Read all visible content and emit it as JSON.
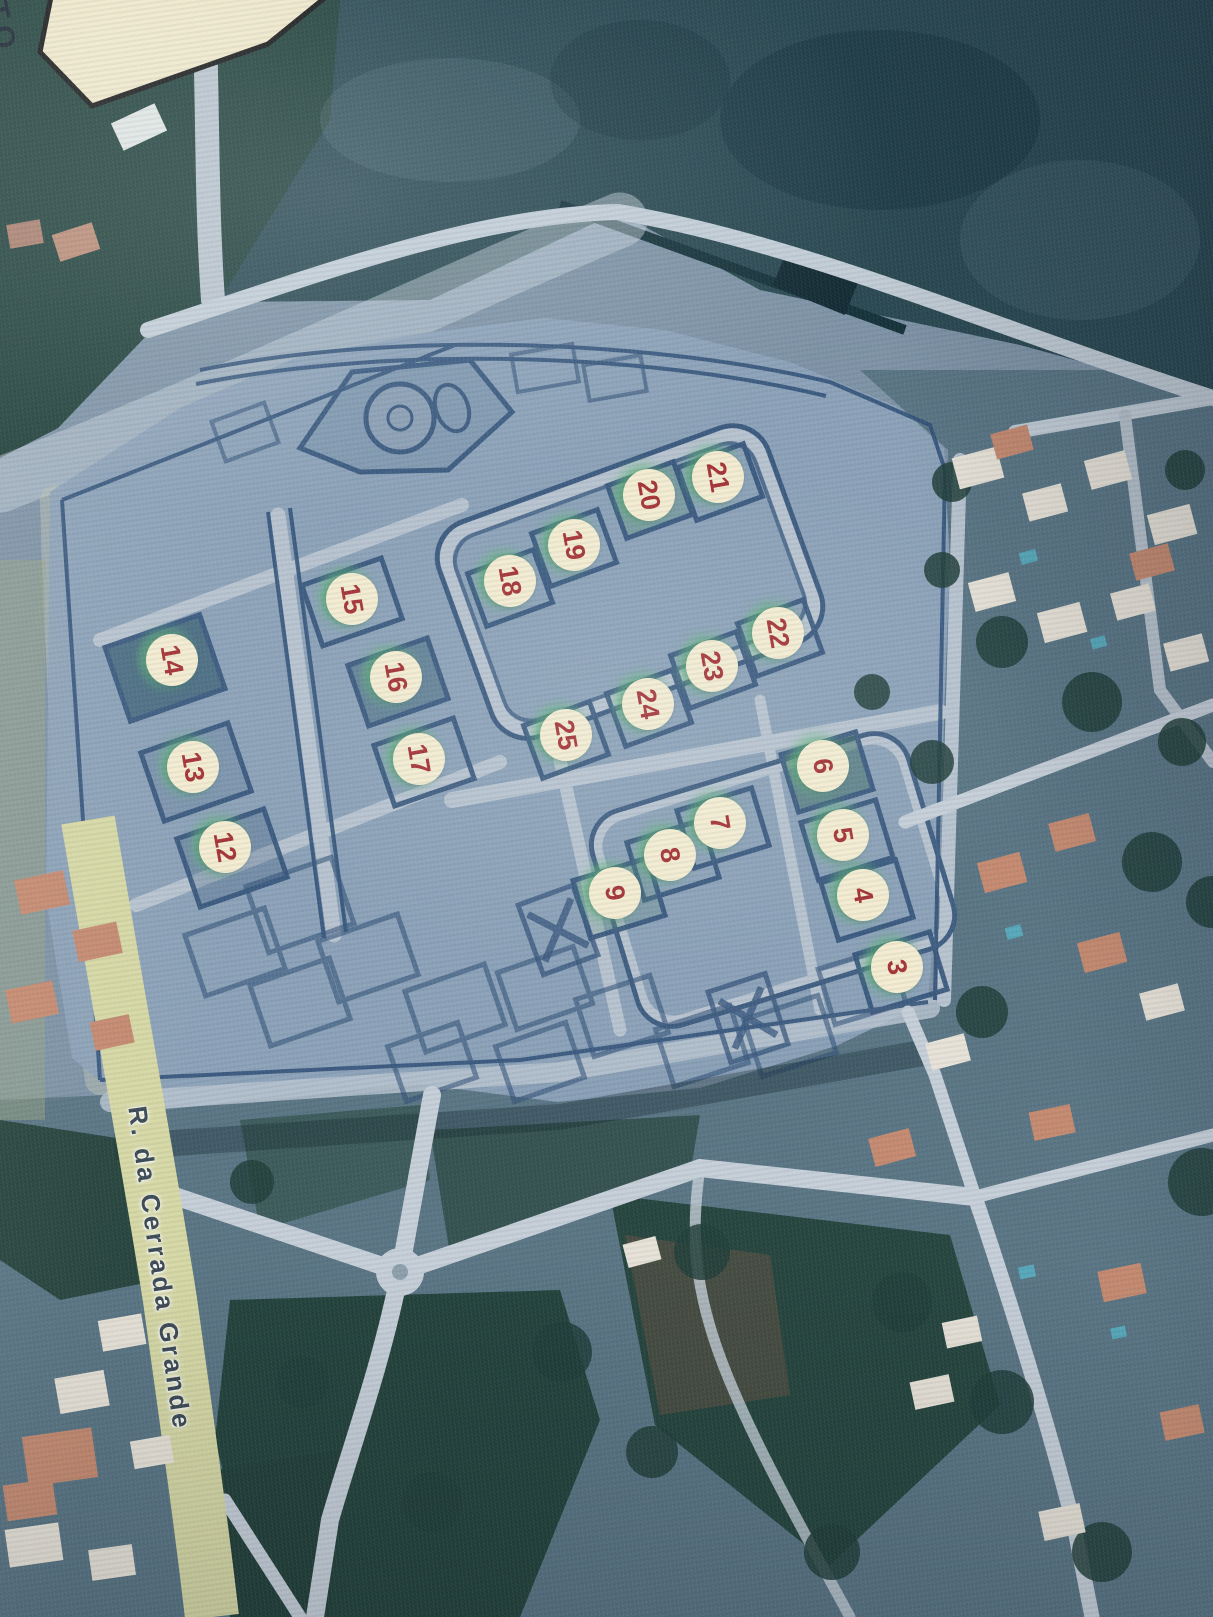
{
  "scene": {
    "description": "Aerial satellite photo of a planned housing development with numbered lot stickers",
    "street_label": "R. da Cerrada Grande",
    "corner_note": "TO"
  },
  "colors": {
    "marker_fill": "#f3ecd1",
    "marker_number": "#a53336",
    "marker_glow": "#6fbf85",
    "street_label_text": "#3c4a55",
    "road_yellow": "#d6d8a5",
    "plat_fill": "#8da2b8",
    "lot_line": "#315178"
  },
  "markers": [
    {
      "number": "3",
      "x": 897,
      "y": 967
    },
    {
      "number": "4",
      "x": 863,
      "y": 895
    },
    {
      "number": "5",
      "x": 843,
      "y": 835
    },
    {
      "number": "6",
      "x": 823,
      "y": 766
    },
    {
      "number": "7",
      "x": 720,
      "y": 823
    },
    {
      "number": "8",
      "x": 670,
      "y": 855
    },
    {
      "number": "9",
      "x": 615,
      "y": 893
    },
    {
      "number": "12",
      "x": 225,
      "y": 847
    },
    {
      "number": "13",
      "x": 193,
      "y": 767
    },
    {
      "number": "14",
      "x": 172,
      "y": 660
    },
    {
      "number": "15",
      "x": 352,
      "y": 599
    },
    {
      "number": "16",
      "x": 396,
      "y": 677
    },
    {
      "number": "17",
      "x": 419,
      "y": 759
    },
    {
      "number": "18",
      "x": 510,
      "y": 581
    },
    {
      "number": "19",
      "x": 574,
      "y": 545
    },
    {
      "number": "20",
      "x": 649,
      "y": 495
    },
    {
      "number": "21",
      "x": 718,
      "y": 477
    },
    {
      "number": "22",
      "x": 778,
      "y": 633
    },
    {
      "number": "23",
      "x": 712,
      "y": 666
    },
    {
      "number": "24",
      "x": 648,
      "y": 704
    },
    {
      "number": "25",
      "x": 566,
      "y": 735
    }
  ]
}
